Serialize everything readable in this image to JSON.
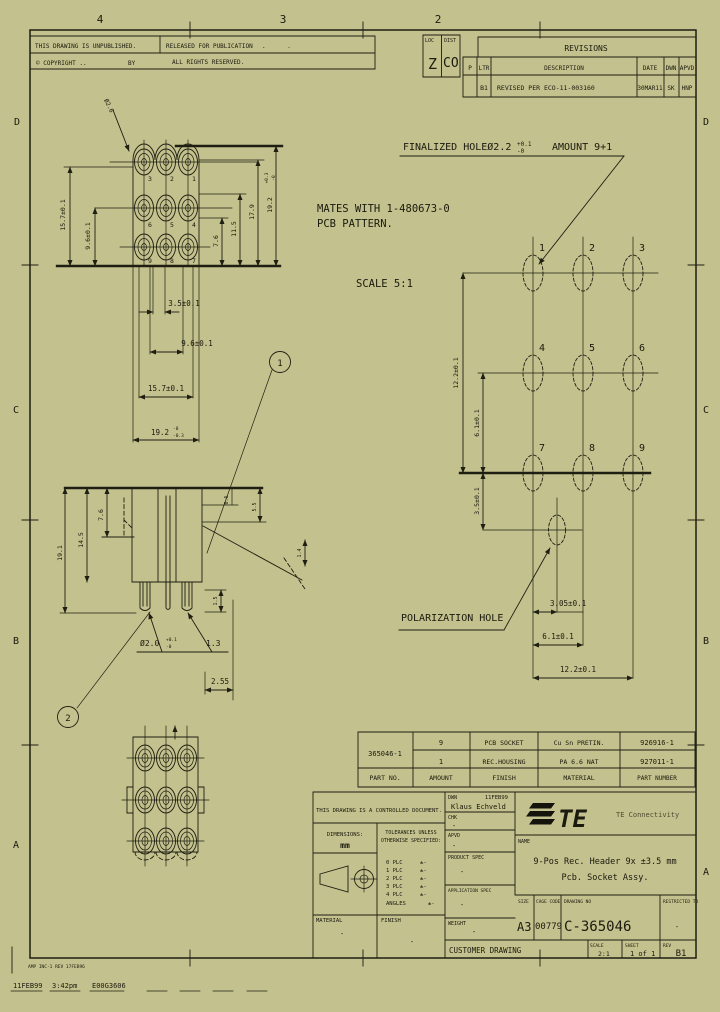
{
  "colors": {
    "paper": "#c3c18d",
    "ink": "#1e1e12"
  },
  "zones": {
    "top": [
      "4",
      "3",
      "2"
    ],
    "left": [
      "D",
      "C",
      "B",
      "A"
    ],
    "right": [
      "D",
      "C",
      "B",
      "A"
    ]
  },
  "header": {
    "unpublished": "THIS DRAWING IS UNPUBLISHED.",
    "released": "RELEASED FOR PUBLICATION",
    "released_dots": ".      .",
    "copyright": "© COPYRIGHT ..",
    "by": "BY",
    "rights": "ALL RIGHTS RESERVED.",
    "loc_label": "LOC",
    "loc_value": "Z",
    "dist_label": "DIST",
    "dist_value": "CO"
  },
  "revisions": {
    "title": "REVISIONS",
    "col_p": "P",
    "col_ltr": "LTR",
    "col_desc": "DESCRIPTION",
    "col_date": "DATE",
    "col_dwn": "DWN",
    "col_apvd": "APVD",
    "row": {
      "ltr": "B1",
      "desc": "REVISED PER ECO-11-003160",
      "date": "30MAR11",
      "dwn": "SK",
      "apvd": "HNP"
    }
  },
  "notes": {
    "finalized": "FINALIZED HOLEØ2.2",
    "finalized_tol_top": "+0.1",
    "finalized_tol_bot": "-0",
    "amount": "AMOUNT 9+1",
    "mates1": "MATES WITH 1-480673-0",
    "mates2": "PCB PATTERN.",
    "scale": "SCALE 5:1",
    "polarization": "POLARIZATION HOLE"
  },
  "balloons": {
    "b1": "1",
    "b2": "2"
  },
  "front_view": {
    "pins": [
      "3",
      "2",
      "1",
      "6",
      "5",
      "4",
      "9",
      "8",
      "7"
    ],
    "lead_dia": "Ø2.6",
    "left_157": "15.7±0.1",
    "left_96": "9.6±0.1",
    "right_76": "7.6",
    "right_115": "11.5",
    "right_179": "17.9",
    "right_192": "19.2",
    "right_192_top": "+0.3",
    "right_192_bot": "-0",
    "bot_35": "3.5±0.1",
    "bot_96": "9.6±0.1",
    "bot_157": "15.7±0.1",
    "bot_192": "19.2",
    "bot_192_top": "-0",
    "bot_192_bot": "-0.3"
  },
  "section_view": {
    "left_191": "19.1",
    "left_145": "14.5",
    "left_76": "7.6",
    "right_06": "0.6",
    "right_55": "5.5",
    "right_14": "1.4",
    "dia": "Ø2.0",
    "dia_top": "+0.1",
    "dia_bot": "-0",
    "d13": "1.3",
    "d15": "1.5",
    "d255": "2.55"
  },
  "pattern_view": {
    "pins": [
      "1",
      "2",
      "3",
      "4",
      "5",
      "6",
      "7",
      "8",
      "9"
    ],
    "v122": "12.2±0.1",
    "v61": "6.1±0.1",
    "v35": "3.5±0.1",
    "h305": "3.05±0.1",
    "h61": "6.1±0.1",
    "h122": "12.2±0.1"
  },
  "parts_table": {
    "part_no": "365046-1",
    "h_part_no": "PART NO.",
    "h_amount": "AMOUNT",
    "h_finish": "FINISH",
    "h_material": "MATERIAL",
    "h_number": "PART NUMBER",
    "rows": [
      {
        "amount": "9",
        "desc": "PCB SOCKET",
        "material": "Cu Sn PRETIN.",
        "number": "926916-1"
      },
      {
        "amount": "1",
        "desc": "REC.HOUSING",
        "material": "PA 6.6 NAT",
        "number": "927011-1"
      }
    ]
  },
  "title_block": {
    "controlled": "THIS DRAWING IS A CONTROLLED DOCUMENT.",
    "dim_label": "DIMENSIONS:",
    "dim_units": "mm",
    "tol_line1": "TOLERANCES UNLESS",
    "tol_line2": "OTHERWISE SPECIFIED:",
    "plc": [
      {
        "k": "0 PLC",
        "v": "±-"
      },
      {
        "k": "1 PLC",
        "v": "±-"
      },
      {
        "k": "2 PLC",
        "v": "±-"
      },
      {
        "k": "3 PLC",
        "v": "±-"
      },
      {
        "k": "4 PLC",
        "v": "±-"
      },
      {
        "k": "ANGLES",
        "v": "±-"
      }
    ],
    "material_label": "MATERIAL",
    "material_value": "-",
    "finish_label": "FINISH",
    "finish_value": "-",
    "dwn_label": "DWN",
    "dwn_name": "Klaus Echveld",
    "dwn_date": "11FEB99",
    "chk_label": "CHK",
    "chk_value": "-",
    "apvd_label": "APVD",
    "apvd_value": "-",
    "product_spec_label": "PRODUCT SPEC",
    "product_spec_value": "-",
    "app_spec_label": "APPLICATION SPEC",
    "app_spec_value": "-",
    "weight_label": "WEIGHT",
    "weight_value": "-",
    "brand_te": "TE",
    "brand_name": "TE Connectivity",
    "name_label": "NAME",
    "title1": "9-Pos Rec. Header 9x ±3.5 mm",
    "title2": "Pcb. Socket Assy.",
    "size_label": "SIZE",
    "size_value": "A3",
    "cage_label": "CAGE CODE",
    "cage_value": "00779",
    "dwg_label": "DRAWING NO",
    "dwg_value": "C-365046",
    "restricted_label": "RESTRICTED TO",
    "restricted_value": "-",
    "customer": "CUSTOMER DRAWING",
    "scale_label": "SCALE",
    "scale_value": "2:1",
    "sheet_label": "SHEET",
    "sheet_of": "1 of 1",
    "rev_label": "REV",
    "rev_value": "B1"
  },
  "footer": {
    "form": "AMP INC-1 REV 17FEB96",
    "date": "11FEB99",
    "time": "3:42pm",
    "code": "E00G3606"
  }
}
